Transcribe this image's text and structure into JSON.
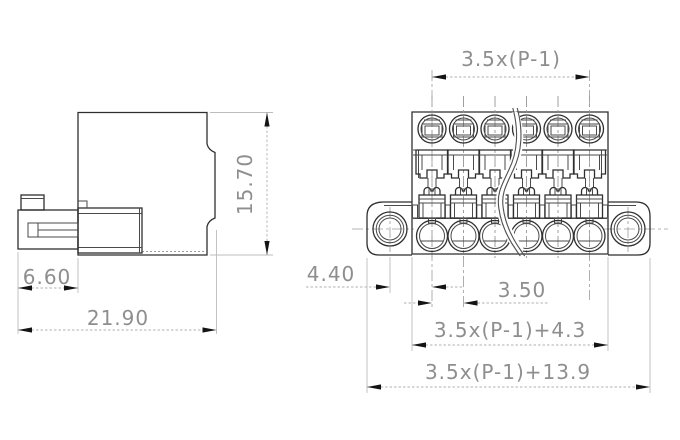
{
  "drawing": {
    "views": {
      "side": {
        "dims": {
          "height": "15.70",
          "latch_width": "6.60",
          "total_depth": "21.90"
        }
      },
      "front": {
        "poles_shown": 6,
        "dims": {
          "pole_span": "3.5x(P-1)",
          "hole_to_first_pole": "4.40",
          "pitch": "3.50",
          "body_width": "3.5x(P-1)+4.3",
          "overall_width": "3.5x(P-1)+13.9"
        }
      }
    },
    "colors": {
      "background": "#ffffff",
      "outline": "#3f3f3f",
      "dim_line": "#b6b6b6",
      "arrow": "#141414",
      "dim_text": "#8e8e8e"
    }
  }
}
